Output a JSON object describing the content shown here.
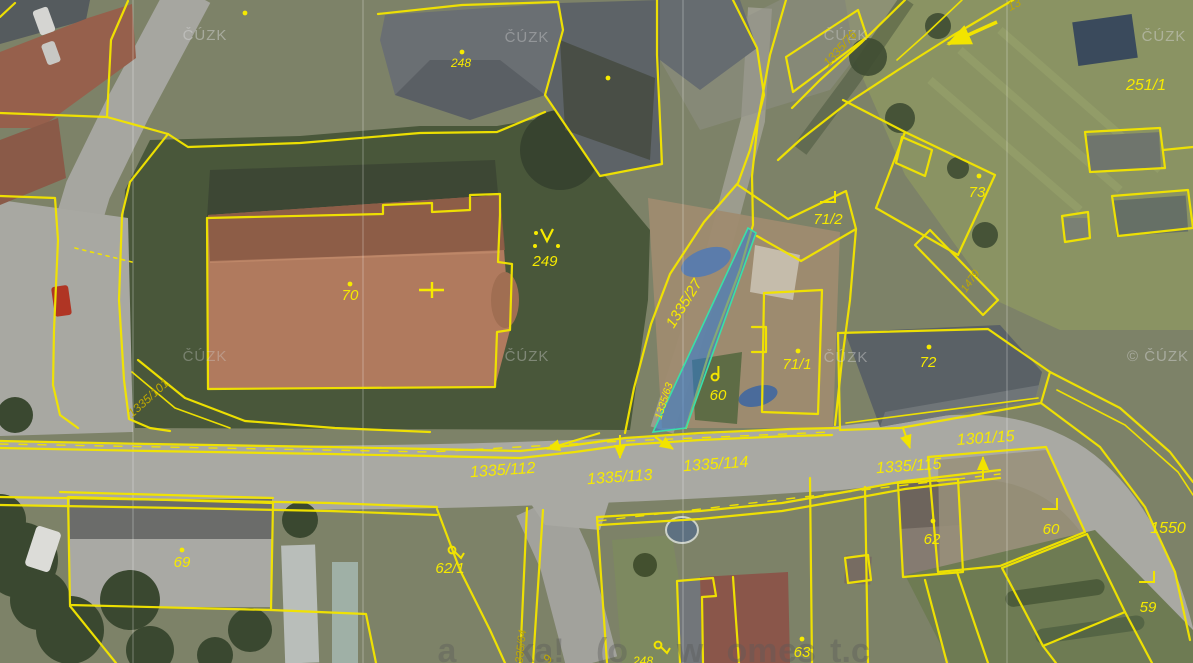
{
  "map": {
    "provider_watermark": "ČÚZK",
    "colors": {
      "parcel_line": "#f2e400",
      "label_bright": "#f6ea00",
      "label_olive": "#bfa900",
      "highlight_fill": "#2e7cd6",
      "highlight_stroke": "#3ae0a8",
      "watermark": "#d2d2d2"
    },
    "watermarks": [
      {
        "text": "ČÚZK",
        "x": 205,
        "y": 40,
        "o": 0.5
      },
      {
        "text": "ČÚZK",
        "x": 527,
        "y": 42,
        "o": 0.4
      },
      {
        "text": "ČÚZK",
        "x": 846,
        "y": 40,
        "o": 0.4
      },
      {
        "text": "ČÚZK",
        "x": 1164,
        "y": 41,
        "o": 0.5
      },
      {
        "text": "ČÚZK",
        "x": 205,
        "y": 361,
        "o": 0.35
      },
      {
        "text": "ČÚZK",
        "x": 527,
        "y": 361,
        "o": 0.4
      },
      {
        "text": "ČÚZK",
        "x": 846,
        "y": 362,
        "o": 0.45
      },
      {
        "text": "© ČÚZK",
        "x": 1158,
        "y": 361,
        "o": 0.5
      }
    ],
    "bottom_watermark_fragments": [
      {
        "text": "a",
        "x": 447
      },
      {
        "text": "ka!",
        "x": 540
      },
      {
        "text": "(o",
        "x": 612
      },
      {
        "text": "w",
        "x": 690
      },
      {
        "text": "om",
        "x": 752
      },
      {
        "text": "es",
        "x": 797
      },
      {
        "text": "t.c",
        "x": 850
      }
    ],
    "parcel_labels": [
      {
        "text": "248",
        "x": 461,
        "y": 67,
        "rot": 0,
        "size": 12,
        "tone": "bright"
      },
      {
        "text": "249",
        "x": 545,
        "y": 266,
        "rot": 0,
        "size": 15,
        "tone": "bright"
      },
      {
        "text": "70",
        "x": 350,
        "y": 300,
        "rot": 0,
        "size": 15,
        "tone": "bright"
      },
      {
        "text": "251/1",
        "x": 1146,
        "y": 90,
        "rot": 0,
        "size": 16,
        "tone": "bright"
      },
      {
        "text": "73",
        "x": 977,
        "y": 197,
        "rot": 0,
        "size": 15,
        "tone": "bright"
      },
      {
        "text": "71/2",
        "x": 828,
        "y": 224,
        "rot": 0,
        "size": 15,
        "tone": "bright"
      },
      {
        "text": "71/1",
        "x": 797,
        "y": 369,
        "rot": 0,
        "size": 15,
        "tone": "bright"
      },
      {
        "text": "72",
        "x": 928,
        "y": 367,
        "rot": 0,
        "size": 15,
        "tone": "bright"
      },
      {
        "text": "60",
        "x": 718,
        "y": 400,
        "rot": 0,
        "size": 15,
        "tone": "bright"
      },
      {
        "text": "60",
        "x": 1051,
        "y": 534,
        "rot": 0,
        "size": 15,
        "tone": "bright"
      },
      {
        "text": "59",
        "x": 1148,
        "y": 612,
        "rot": 0,
        "size": 15,
        "tone": "bright"
      },
      {
        "text": "62",
        "x": 932,
        "y": 544,
        "rot": 0,
        "size": 15,
        "tone": "bright"
      },
      {
        "text": "62/1",
        "x": 450,
        "y": 573,
        "rot": 0,
        "size": 15,
        "tone": "bright"
      },
      {
        "text": "69",
        "x": 182,
        "y": 567,
        "rot": 0,
        "size": 15,
        "tone": "bright"
      },
      {
        "text": "63",
        "x": 802,
        "y": 657,
        "rot": 0,
        "size": 15,
        "tone": "bright"
      },
      {
        "text": "248",
        "x": 643,
        "y": 665,
        "rot": 0,
        "size": 12,
        "tone": "bright"
      },
      {
        "text": "1550",
        "x": 1168,
        "y": 533,
        "rot": 0,
        "size": 16,
        "tone": "bright"
      },
      {
        "text": "1335/27",
        "x": 688,
        "y": 306,
        "rot": -58,
        "size": 15,
        "tone": "bright"
      },
      {
        "text": "1335/63",
        "x": 667,
        "y": 402,
        "rot": -72,
        "size": 10.5,
        "tone": "bright"
      },
      {
        "text": "1335/76",
        "x": 843,
        "y": 51,
        "rot": -48,
        "size": 12,
        "tone": "olive"
      },
      {
        "text": "13",
        "x": 1016,
        "y": 8,
        "rot": -28,
        "size": 12,
        "tone": "olive"
      },
      {
        "text": "1479",
        "x": 973,
        "y": 283,
        "rot": -55,
        "size": 11,
        "tone": "olive"
      },
      {
        "text": "1335/101",
        "x": 151,
        "y": 401,
        "rot": -42,
        "size": 12,
        "tone": "olive"
      },
      {
        "text": "1335/112",
        "x": 503,
        "y": 475,
        "rot": -4,
        "size": 16,
        "tone": "bright"
      },
      {
        "text": "1335/113",
        "x": 620,
        "y": 482,
        "rot": -4,
        "size": 16,
        "tone": "bright"
      },
      {
        "text": "1335/114",
        "x": 716,
        "y": 469,
        "rot": -4,
        "size": 16,
        "tone": "bright"
      },
      {
        "text": "1335/115",
        "x": 909,
        "y": 471,
        "rot": -4,
        "size": 16,
        "tone": "bright"
      },
      {
        "text": "1301/15",
        "x": 986,
        "y": 443,
        "rot": -4,
        "size": 16,
        "tone": "bright"
      },
      {
        "text": "1335/64",
        "x": 524,
        "y": 650,
        "rot": -84,
        "size": 11,
        "tone": "olive"
      },
      {
        "text": "9",
        "x": 551,
        "y": 661,
        "rot": -55,
        "size": 12,
        "tone": "olive"
      }
    ],
    "highlighted_parcel": {
      "label": "1335/63",
      "points": "748,228 756,233 686,428 653,432"
    },
    "point_markers": [
      [
        245,
        13
      ],
      [
        462,
        52
      ],
      [
        350,
        284
      ],
      [
        608,
        78
      ],
      [
        979,
        176
      ],
      [
        798,
        351
      ],
      [
        929,
        347
      ],
      [
        933,
        521
      ],
      [
        182,
        550
      ],
      [
        802,
        639
      ]
    ],
    "corner_markers": [
      [
        829,
        197
      ],
      [
        1051,
        504
      ],
      [
        1148,
        577
      ]
    ],
    "loop_markers": [
      [
        715,
        377
      ],
      [
        452,
        550
      ],
      [
        658,
        645
      ]
    ],
    "church_symbol": {
      "x": 547,
      "y": 237
    },
    "survey_cross": {
      "x": 431,
      "y": 290
    },
    "arrows": [
      {
        "x1": 600,
        "y1": 433,
        "x2": 547,
        "y2": 449,
        "w": 2
      },
      {
        "x1": 620,
        "y1": 435,
        "x2": 620,
        "y2": 458,
        "w": 2
      },
      {
        "x1": 655,
        "y1": 437,
        "x2": 673,
        "y2": 449,
        "w": 2
      },
      {
        "x1": 903,
        "y1": 428,
        "x2": 910,
        "y2": 448,
        "w": 2
      },
      {
        "x1": 983,
        "y1": 480,
        "x2": 983,
        "y2": 457,
        "w": 2
      },
      {
        "x1": 997,
        "y1": 22,
        "x2": 948,
        "y2": 44,
        "w": 3.5
      }
    ]
  }
}
